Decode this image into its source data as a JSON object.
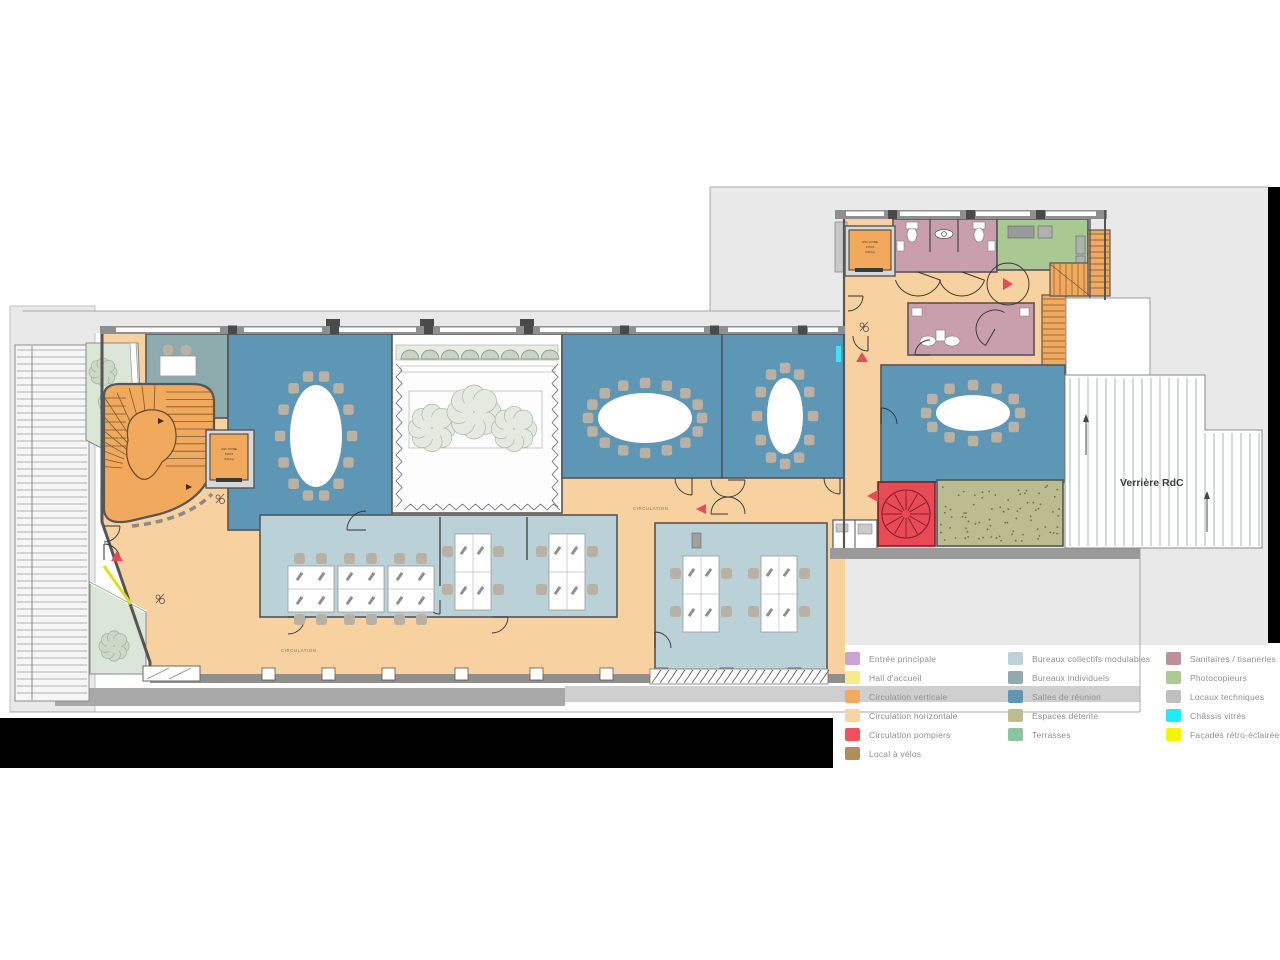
{
  "plan": {
    "verriere_label": "Verrière RdC",
    "circulation_labels": [
      "CIRCULATION",
      "CIRCULATION"
    ],
    "elevator_label": {
      "l1": "ASC KONE",
      "l2": "8 PAX",
      "l3": "630 kg"
    }
  },
  "colors": {
    "wall": "#565656",
    "facade": "#8f8f8f",
    "street": "#e9e9e9",
    "street_line": "#b2b2b2",
    "peach": "#f7d1a0",
    "orange": "#f1a95e",
    "red": "#e84a56",
    "blue": "#5e96b6",
    "lightblue": "#bad1d7",
    "teal": "#8dabad",
    "mauve": "#c99fad",
    "green": "#a9c892",
    "khaki": "#bcbc90",
    "terrace": "#dbe5d8",
    "tree_fill": "#e4eae1",
    "tree_stroke": "#a9b8a6",
    "chair": "#b9b1a4",
    "court": "#fdfdfd",
    "cyan": "#3fe2f2",
    "yellow": "#dede20",
    "black_bar": "#000000",
    "legend_text": "#8f8f8f"
  },
  "legend": {
    "columns": [
      {
        "items": [
          {
            "label": "Entrée principale",
            "color": "#c9a2d6"
          },
          {
            "label": "Hall d'accueil",
            "color": "#f7e98e"
          },
          {
            "label": "Circulation verticale",
            "color": "#f2ab5e"
          },
          {
            "label": "Circulation horizontale",
            "color": "#f7d4a4"
          },
          {
            "label": "Circulation pompiers",
            "color": "#f1505e"
          },
          {
            "label": "Local à vélos",
            "color": "#b28d5c"
          }
        ]
      },
      {
        "items": [
          {
            "label": "Bureaux collectifs modulables",
            "color": "#bdd2d8"
          },
          {
            "label": "Bureaux individuels",
            "color": "#8fabad"
          },
          {
            "label": "Salles de réunion",
            "color": "#5e96b6"
          },
          {
            "label": "Espaces détente",
            "color": "#bcbc90"
          },
          {
            "label": "Terrasses",
            "color": "#8cc6a0"
          }
        ]
      },
      {
        "items": [
          {
            "label": "Sanitaires / tisaneries",
            "color": "#c08e9b"
          },
          {
            "label": "Photocopieurs",
            "color": "#abcb93"
          },
          {
            "label": "Locaux techniques",
            "color": "#bfbfbf"
          },
          {
            "label": "Châssis vitrés",
            "color": "#22e9fb"
          },
          {
            "label": "Façades rétro-éclairées",
            "color": "#f4f400"
          }
        ]
      }
    ]
  }
}
